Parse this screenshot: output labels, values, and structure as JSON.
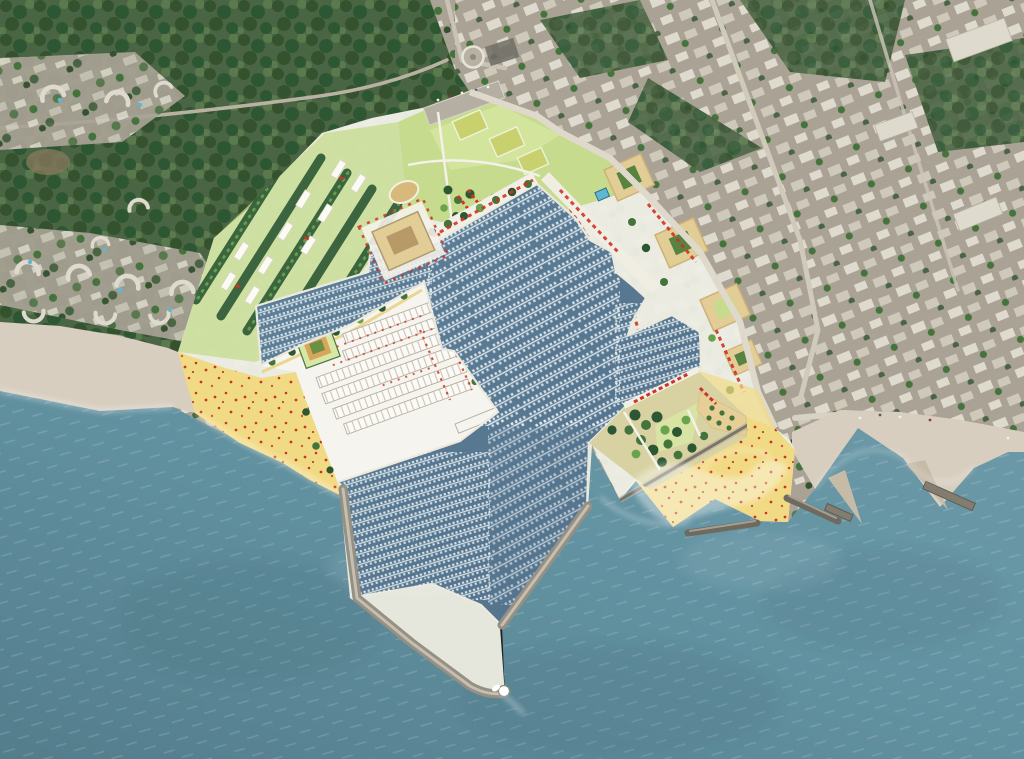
{
  "meta": {
    "title": "Aerial satellite view with marina masterplan overlay — Mediterranean seaside town, harbor basins, breakwaters and beaches",
    "view_type": "top-down aerial masterplan rendering",
    "visible_text": "none"
  },
  "colors": {
    "sea1": "#6d9aa9",
    "sea2": "#547d8c",
    "marina1": "#5f8199",
    "marina2": "#52708a",
    "dock": "#d6e2e7",
    "boat": "#eef4f6",
    "beachNat": "#d7cec0",
    "beachNat2": "#c6bba7",
    "sandYellow": "#f1da84",
    "sandPale": "#f7ecc0",
    "sandOrange": "#e9c05e",
    "planBase": "#edeee4",
    "white": "#f6f4ee",
    "quay": "#ece9dc",
    "lawn": "#c6db8d",
    "lawnBright": "#d8e8a4",
    "field": "#aecf66",
    "court": "#c9d06e",
    "treeDark": "#2d5733",
    "treeMid": "#44743c",
    "treeLight": "#69a34e",
    "forest1": "#4a6544",
    "forest2": "#35522f",
    "forest3": "#5a7a4e",
    "town1": "#a9a295",
    "townBld": "#cec9bb",
    "townBld2": "#dedacd",
    "townRoad": "#c4beae",
    "road": "#ded9cb",
    "red": "#cd3425",
    "tan": "#e2cd96",
    "tanRoof": "#cfb076",
    "tanPlaza": "#e5cf97",
    "breakwater": "#968f83",
    "breakwaterDark": "#6f6a5f",
    "pool": "#5fb7d4",
    "lot": "#6e6d65",
    "track": "#d8b97c"
  },
  "regions": [
    {
      "id": "sea",
      "label": "open sea",
      "color_key": "sea1"
    },
    {
      "id": "marina-basin",
      "label": "marina harbor water with pontoon docks and moored boats",
      "color_key": "marina1"
    },
    {
      "id": "natural-beach-west",
      "label": "existing sandy beach along west coast",
      "color_key": "beachNat"
    },
    {
      "id": "plan-beach-southwest",
      "label": "masterplan yellow beach with red parasols (southwest)",
      "color_key": "sandYellow"
    },
    {
      "id": "plan-beach-southeast",
      "label": "masterplan yellow beach with red parasols (southeast)",
      "color_key": "sandYellow"
    },
    {
      "id": "beach-coves-east",
      "label": "scalloped beach coves with groynes (east)",
      "color_key": "beachNat"
    },
    {
      "id": "masterplan-district",
      "label": "new waterfront district with tree rows, lawns and white buildings",
      "color_key": "planBase"
    },
    {
      "id": "north-park",
      "label": "sports park with playing fields and oval track",
      "color_key": "lawn"
    },
    {
      "id": "boat-storage",
      "label": "dry-stack boat storage rows on harbor platform",
      "color_key": "white"
    },
    {
      "id": "green-peninsula",
      "label": "tree-planted leisure peninsula with plaza",
      "color_key": "treeMid"
    },
    {
      "id": "west-breakwater",
      "label": "west breakwater jetty with lighthouse",
      "color_key": "breakwater"
    },
    {
      "id": "east-breakwater",
      "label": "east entrance jetty",
      "color_key": "breakwater"
    },
    {
      "id": "detached-breakwaters",
      "label": "detached offshore breakwater bars",
      "color_key": "breakwaterDark"
    },
    {
      "id": "old-town",
      "label": "existing town fabric with street grid and trees",
      "color_key": "town1"
    },
    {
      "id": "resort-crescents",
      "label": "crescent-shaped resort buildings with pools",
      "color_key": "townBld2"
    },
    {
      "id": "forest",
      "label": "pine forest canopy",
      "color_key": "forest1"
    },
    {
      "id": "harbor-entrance-boat",
      "label": "small white boat leaving harbor entrance",
      "color_key": "boat"
    }
  ]
}
